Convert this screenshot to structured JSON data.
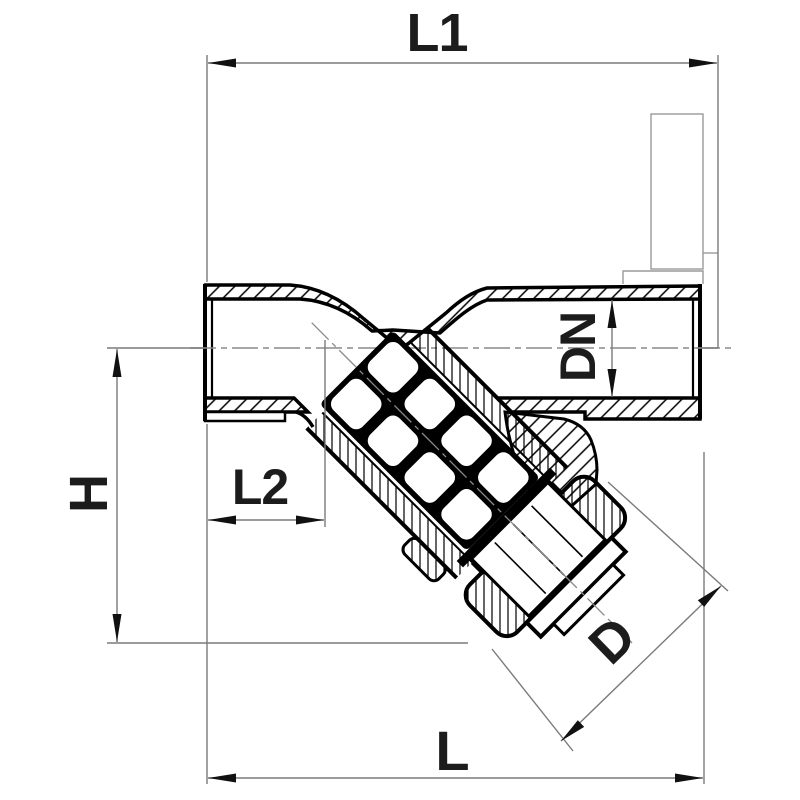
{
  "drawing": {
    "kind": "technical-sectional-drawing",
    "subject": "y-strainer-valve",
    "background_color": "#ffffff",
    "outline_color": "#000000",
    "thin_line_color": "#7a7a7a",
    "label_color": "#1c1c1c",
    "dimensions": [
      {
        "id": "L1",
        "label": "L1"
      },
      {
        "id": "DN",
        "label": "DN"
      },
      {
        "id": "H",
        "label": "H"
      },
      {
        "id": "L2",
        "label": "L2"
      },
      {
        "id": "D",
        "label": "D"
      },
      {
        "id": "L",
        "label": "L"
      }
    ]
  }
}
